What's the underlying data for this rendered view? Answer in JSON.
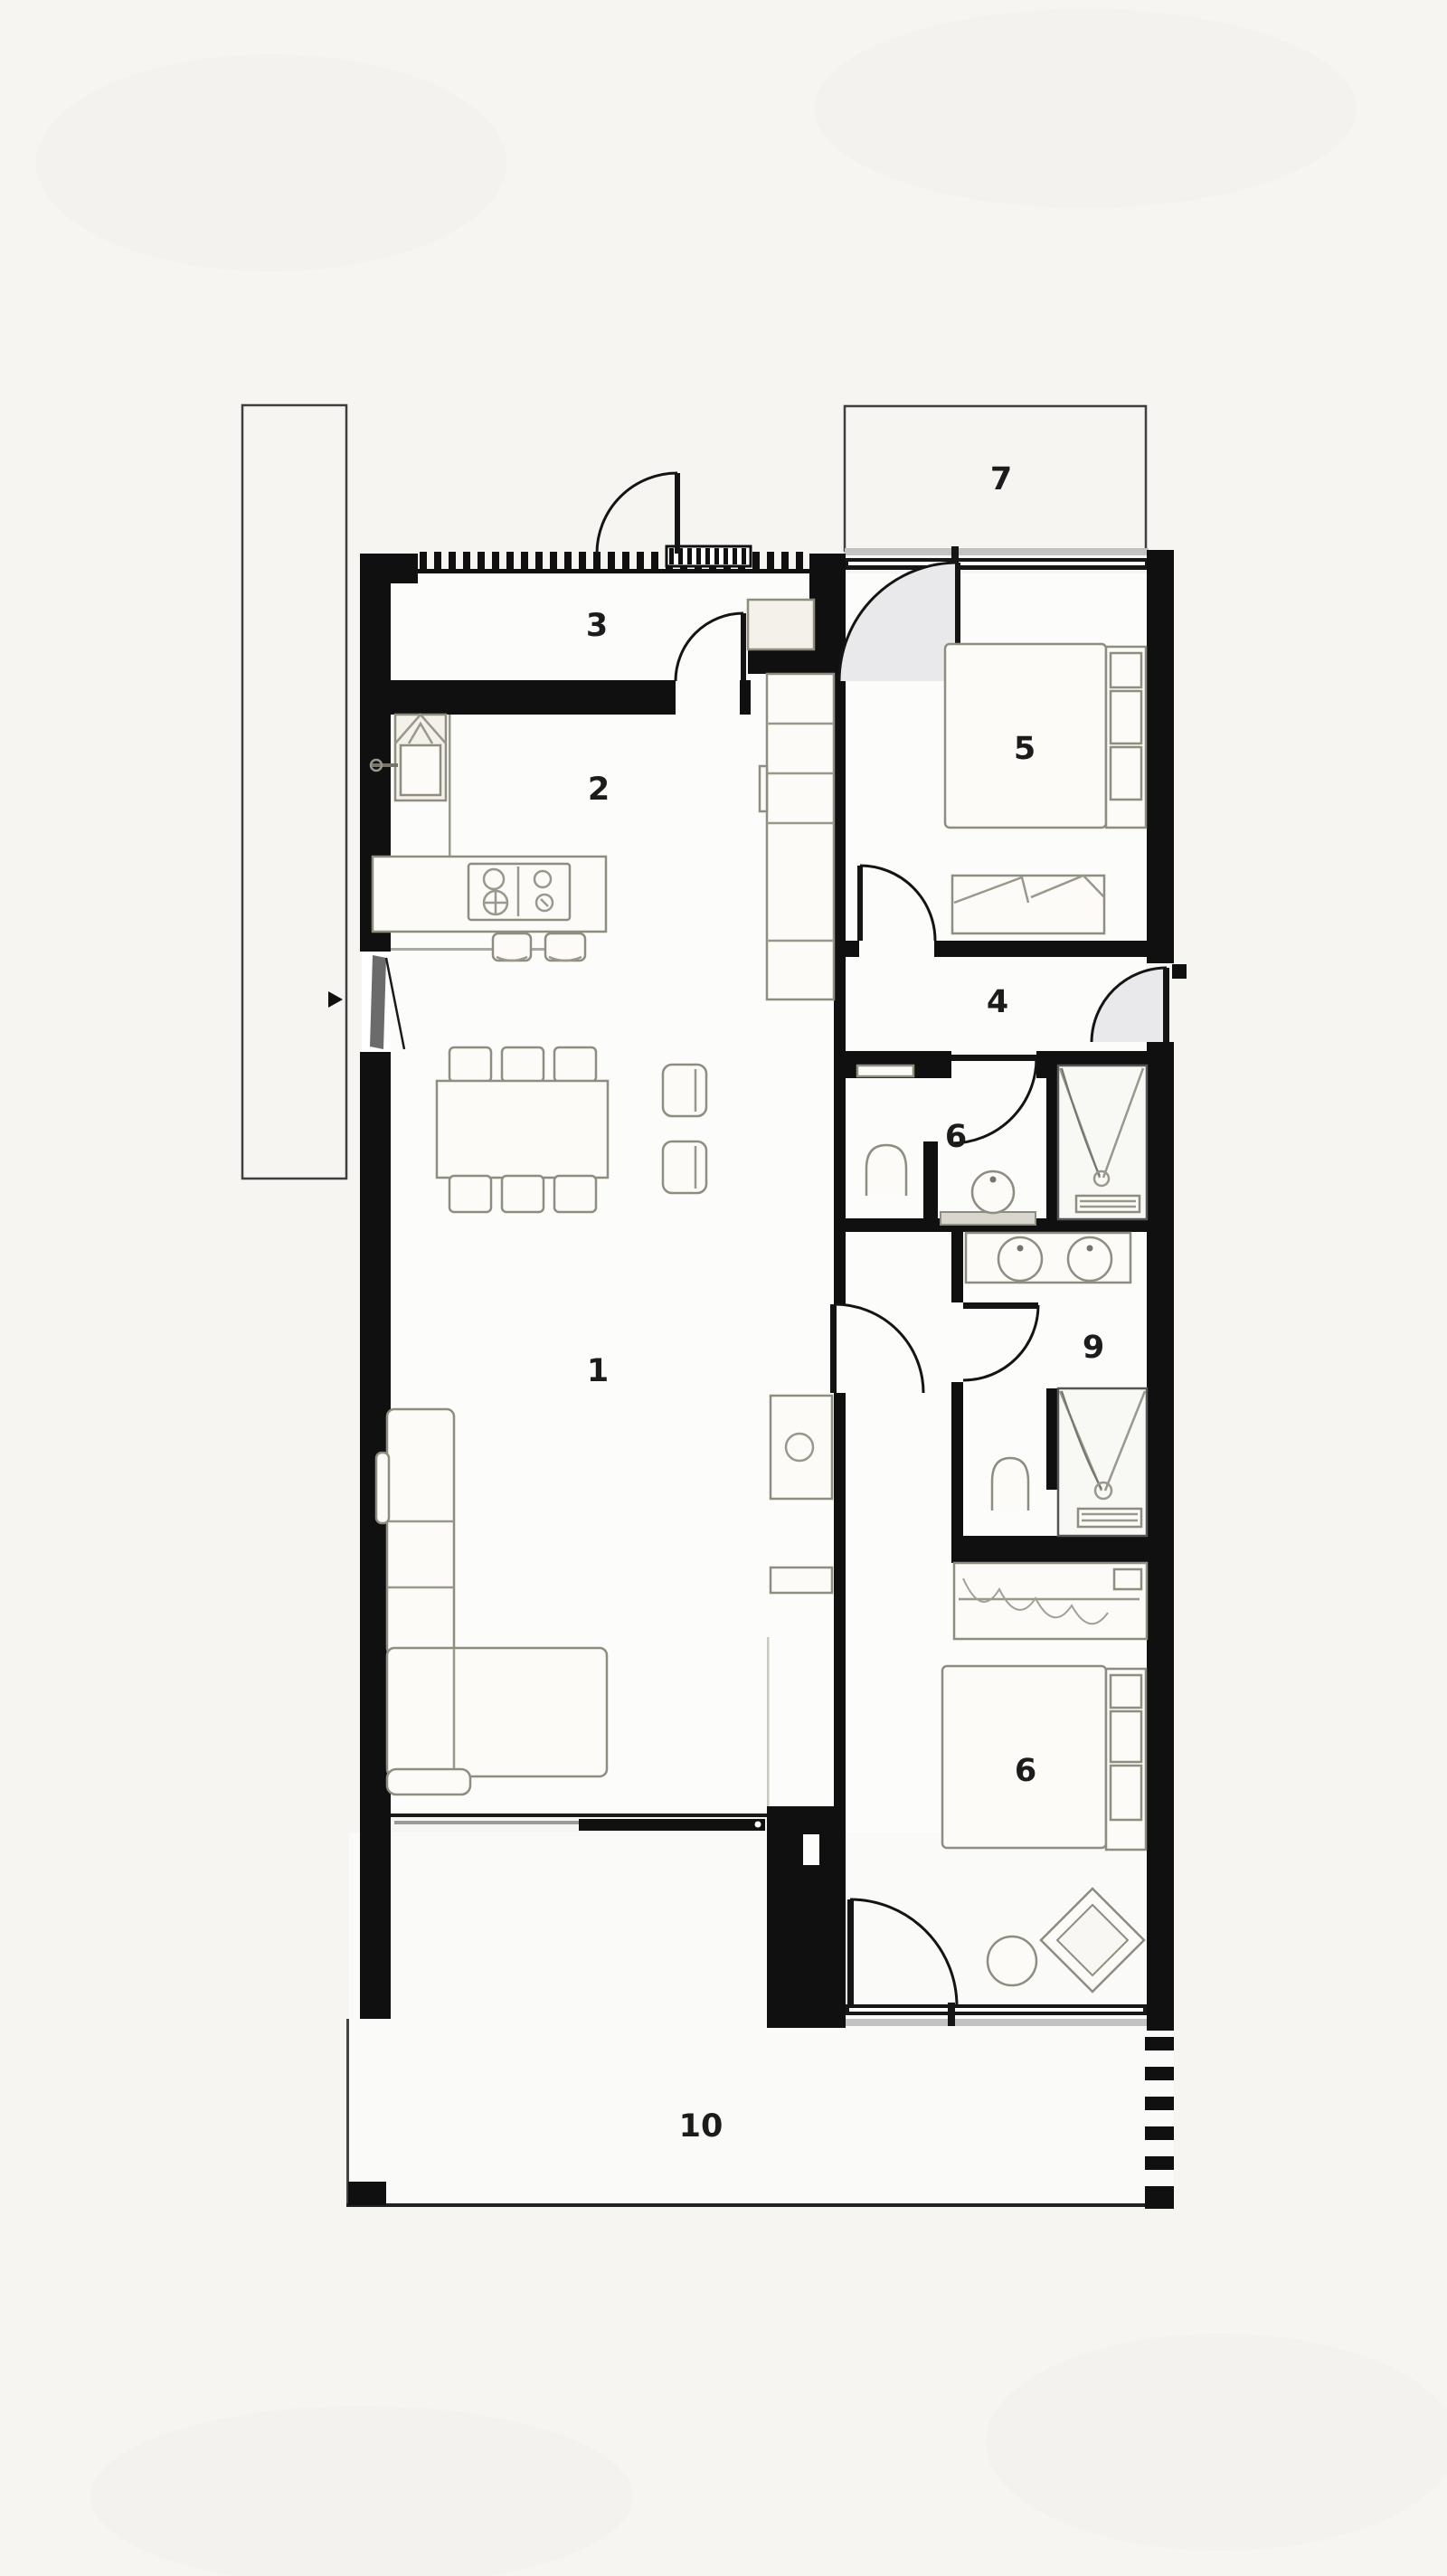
{
  "plan": {
    "rooms": [
      {
        "id": "living-room",
        "number": "1"
      },
      {
        "id": "kitchen",
        "number": "2"
      },
      {
        "id": "entry-hall",
        "number": "3"
      },
      {
        "id": "hallway",
        "number": "4"
      },
      {
        "id": "bedroom-front",
        "number": "5"
      },
      {
        "id": "bathroom",
        "number": "6"
      },
      {
        "id": "front-patio",
        "number": "7"
      },
      {
        "id": "ensuite",
        "number": "9"
      },
      {
        "id": "bedroom-back",
        "number": "6"
      },
      {
        "id": "terrace",
        "number": "10"
      }
    ],
    "colors": {
      "wall": "#101010",
      "paper": "#f6f5f2",
      "furniture_stroke": "#8f8c80",
      "glass": "#c2c2c2",
      "door_sector": "#e9e9ec"
    }
  }
}
